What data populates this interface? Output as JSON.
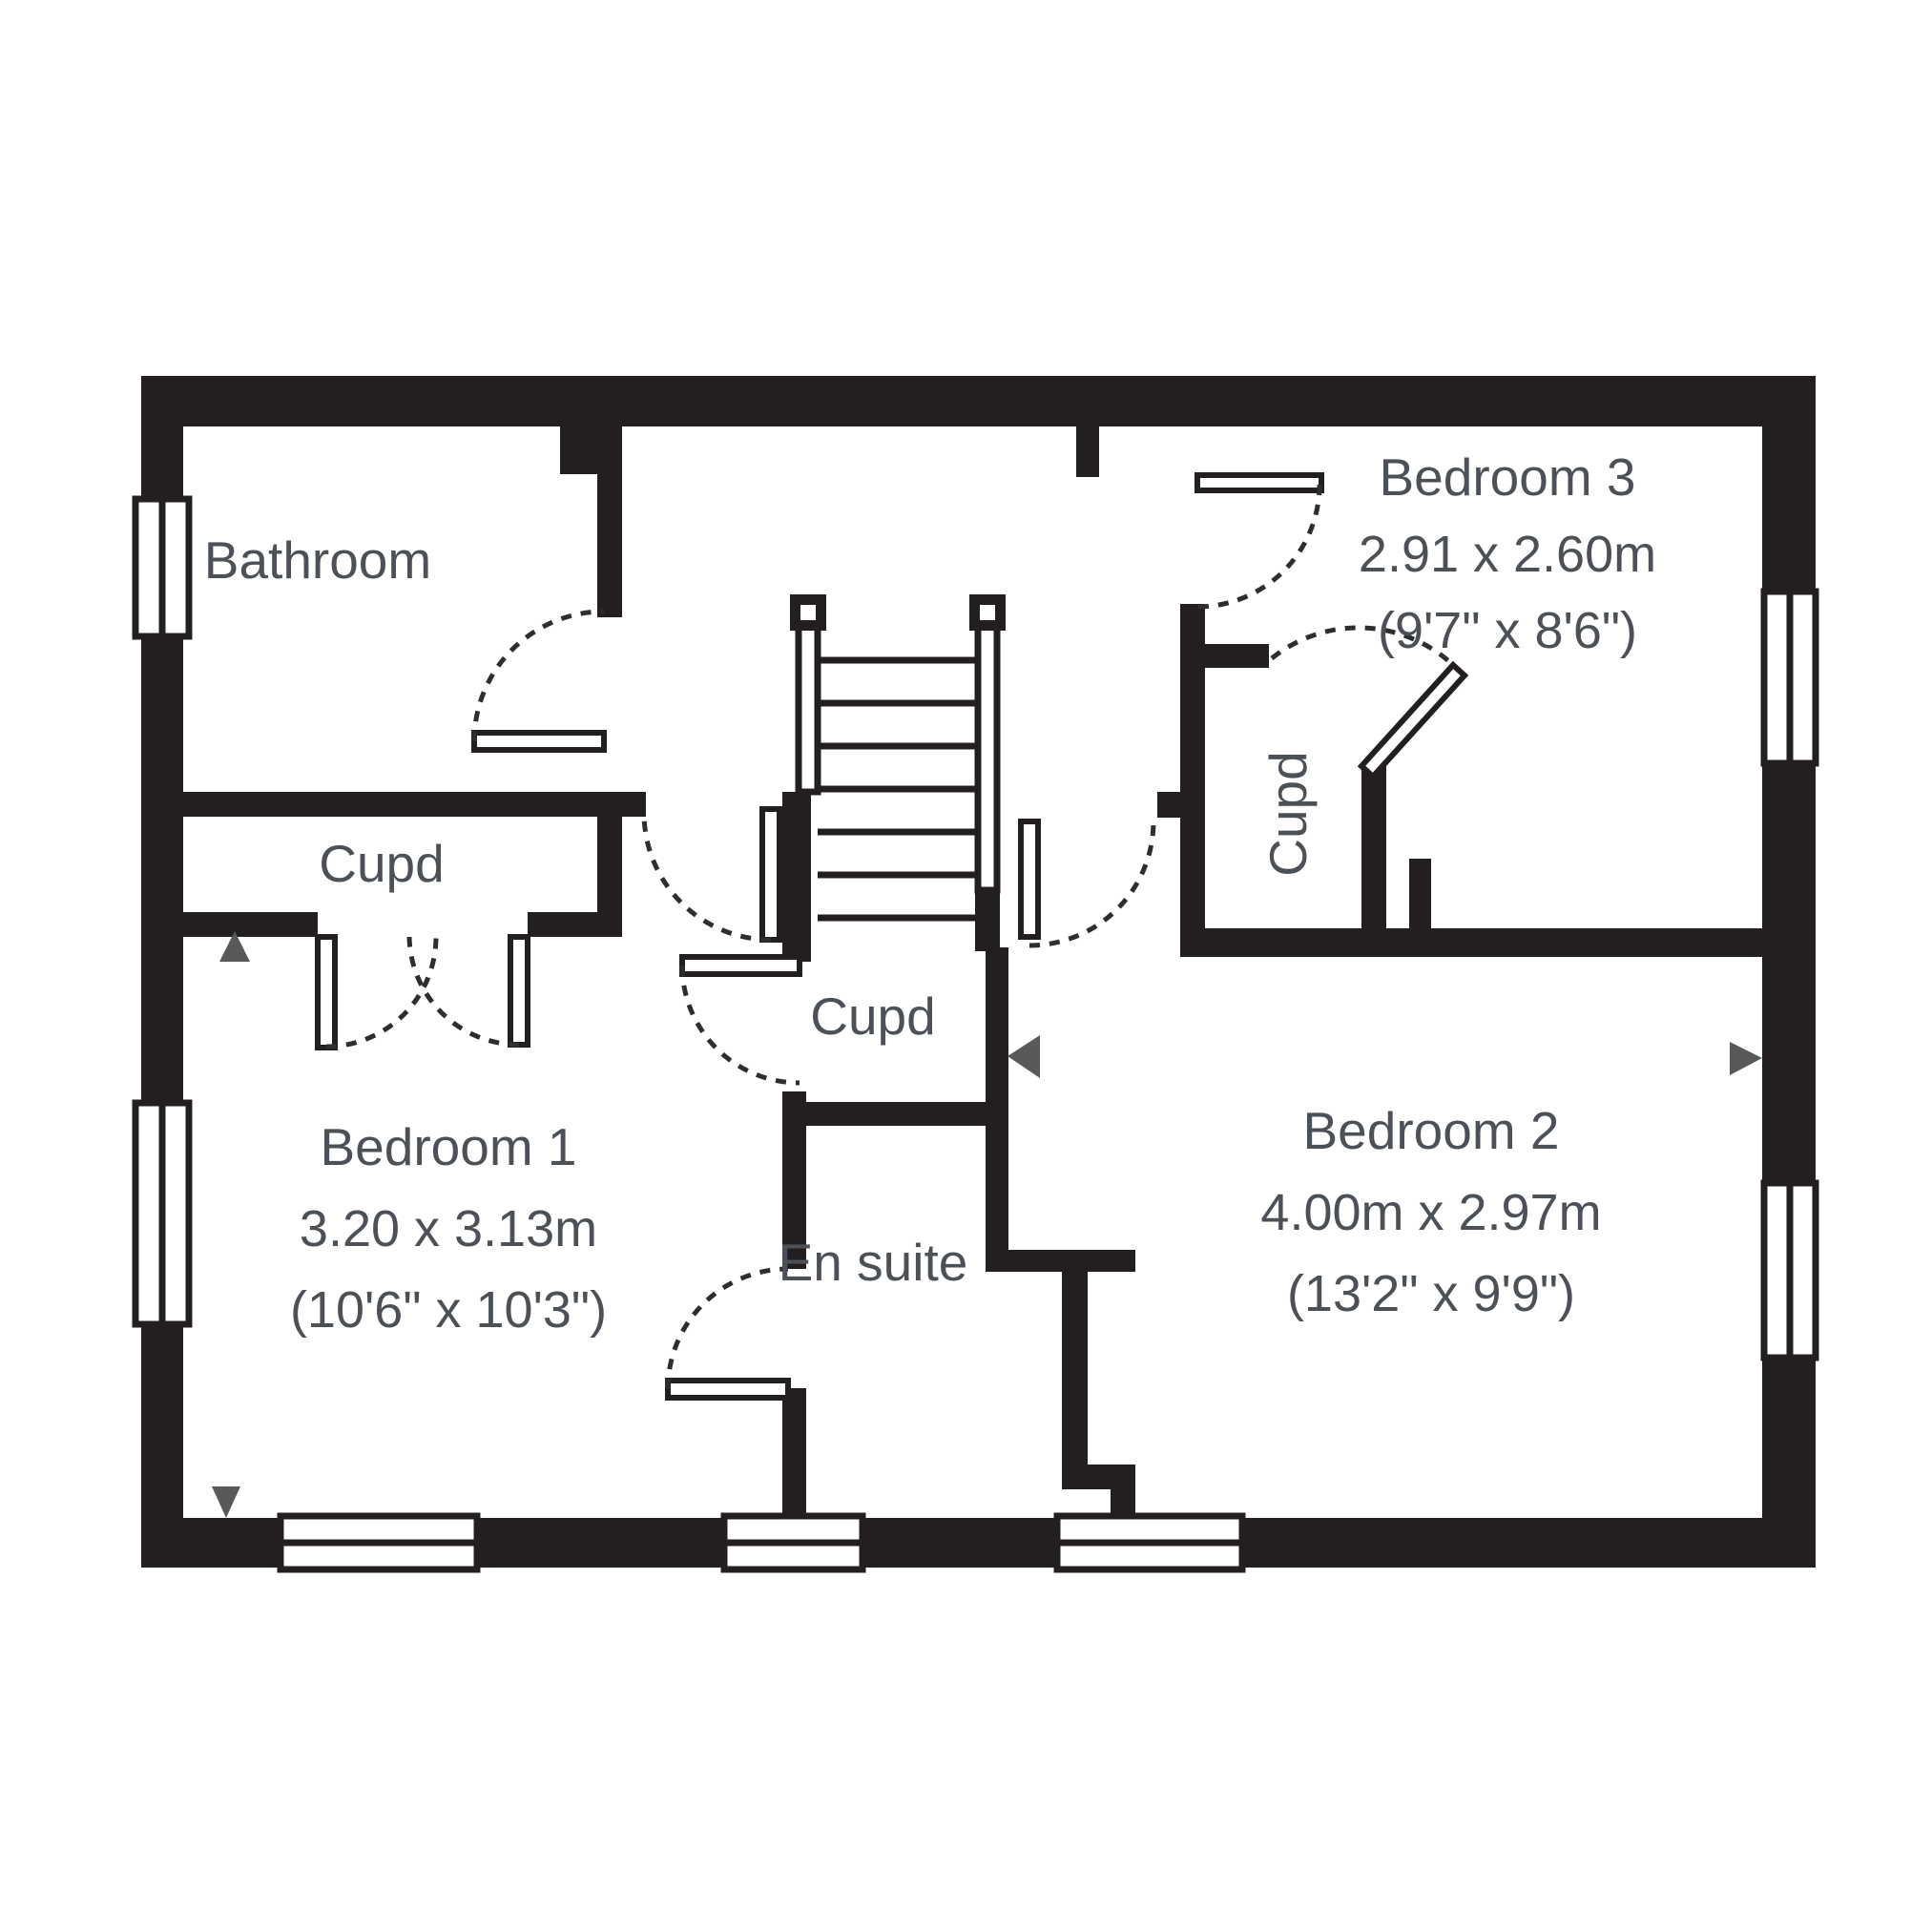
{
  "plan": {
    "title": "First floor plan",
    "rooms": {
      "bathroom": {
        "name": "Bathroom"
      },
      "cupboard_left": {
        "name": "Cupd"
      },
      "cupboard_middle": {
        "name": "Cupd"
      },
      "cupboard_right": {
        "name": "Cupd"
      },
      "ensuite": {
        "name": "En suite"
      },
      "bedroom1": {
        "name": "Bedroom 1",
        "dimensions_metric": "3.20 x 3.13m",
        "dimensions_imperial": "(10'6\" x 10'3\")"
      },
      "bedroom2": {
        "name": "Bedroom 2",
        "dimensions_metric": "4.00m x 2.97m",
        "dimensions_imperial": "(13'2\" x 9'9\")"
      },
      "bedroom3": {
        "name": "Bedroom 3",
        "dimensions_metric": "2.91 x 2.60m",
        "dimensions_imperial": "(9'7\" x 8'6\")"
      }
    },
    "colors": {
      "wall": "#231f20",
      "label_text": "#4c5158",
      "arrow_marker": "#58595b",
      "background": "#ffffff"
    },
    "features": {
      "stairs": "central staircase with rails and treads",
      "windows": 7,
      "door_arrows": 4
    }
  }
}
